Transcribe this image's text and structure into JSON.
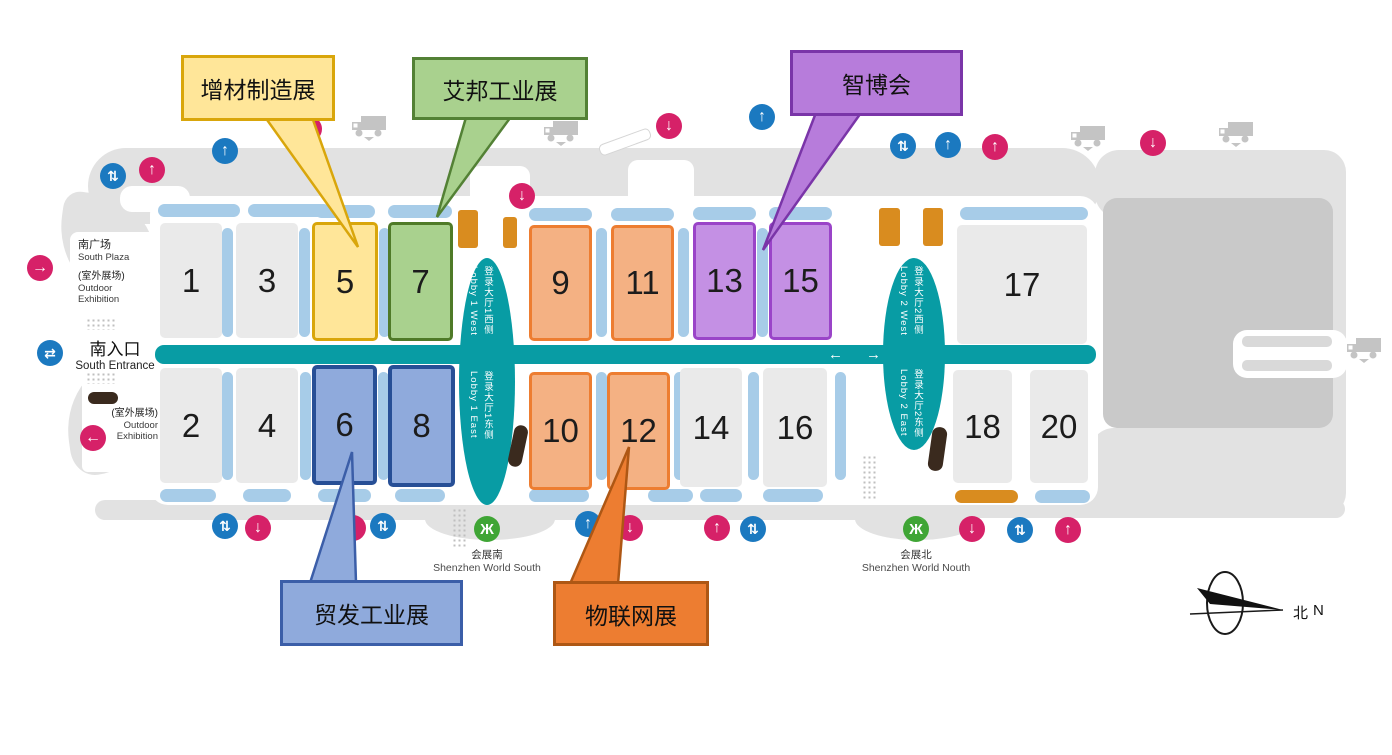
{
  "map_name": "Shenzhen World exhibition hall plan",
  "glyphs": {
    "up": "↑",
    "down": "↓",
    "left": "←",
    "right": "→",
    "updown": "⇅",
    "leftright": "⇄",
    "metro": "Ж"
  },
  "colors": {
    "corridor_teal": "#089CA4",
    "platform_blue": "#A7CCE8",
    "hall_gray": "#EAEAEA",
    "icon_pink": "#D62168",
    "icon_blue": "#1B79C0",
    "metro_green": "#3FA535",
    "amber": "#D98C1F",
    "yellow_fill": "#FFE699",
    "yellow_border": "#D9A60B",
    "green_fill": "#A9D18E",
    "green_border": "#538135",
    "orange_fill": "#F4B183",
    "orange_border": "#ED7D31",
    "purple_fill": "#C490E4",
    "purple_border": "#9A44C8",
    "blue_fill": "#8FAADC",
    "blue_border": "#274F96",
    "orange_callout_fill": "#ED7D31",
    "purple_callout_fill": "#B77CDB"
  },
  "halls": {
    "h1": {
      "number": "1"
    },
    "h2": {
      "number": "2"
    },
    "h3": {
      "number": "3"
    },
    "h4": {
      "number": "4"
    },
    "h5": {
      "number": "5"
    },
    "h6": {
      "number": "6"
    },
    "h7": {
      "number": "7"
    },
    "h8": {
      "number": "8"
    },
    "h9": {
      "number": "9"
    },
    "h10": {
      "number": "10"
    },
    "h11": {
      "number": "11"
    },
    "h12": {
      "number": "12"
    },
    "h13": {
      "number": "13"
    },
    "h14": {
      "number": "14"
    },
    "h15": {
      "number": "15"
    },
    "h16": {
      "number": "16"
    },
    "h17": {
      "number": "17"
    },
    "h18": {
      "number": "18"
    },
    "h20": {
      "number": "20"
    }
  },
  "exhibitions": {
    "additive": {
      "label": "增材制造展",
      "halls": [
        "5"
      ],
      "color": "#FFE699"
    },
    "aibang": {
      "label": "艾邦工业展",
      "halls": [
        "7"
      ],
      "color": "#A9D18E"
    },
    "zhibo": {
      "label": "智博会",
      "halls": [
        "13",
        "15"
      ],
      "color": "#B77CDB"
    },
    "maofa": {
      "label": "贸发工业展",
      "halls": [
        "6",
        "8"
      ],
      "color": "#8FAADC"
    },
    "iot": {
      "label": "物联网展",
      "halls": [
        "9",
        "10",
        "11",
        "12"
      ],
      "color": "#ED7D31"
    }
  },
  "lobbies": {
    "l1w": {
      "cn": "登录大厅1西侧",
      "en": "Lobby 1 West"
    },
    "l1e": {
      "cn": "登录大厅1东侧",
      "en": "Lobby 1 East"
    },
    "l2w": {
      "cn": "登录大厅2西侧",
      "en": "Lobby 2 West"
    },
    "l2e": {
      "cn": "登录大厅2东侧",
      "en": "Lobby 2 East"
    }
  },
  "area_labels": {
    "south_plaza_cn": "南广场",
    "south_plaza_en": "South Plaza",
    "outdoor_cn": "(室外展场)",
    "outdoor_en1": "Outdoor",
    "outdoor_en2": "Exhibition",
    "south_entrance_cn": "南入口",
    "south_entrance_en": "South Entrance"
  },
  "stations": {
    "south": {
      "cn": "会展南",
      "en": "Shenzhen World South"
    },
    "north": {
      "cn": "会展北",
      "en": "Shenzhen World Nouth"
    }
  },
  "compass": {
    "cn": "北",
    "en": "N"
  }
}
